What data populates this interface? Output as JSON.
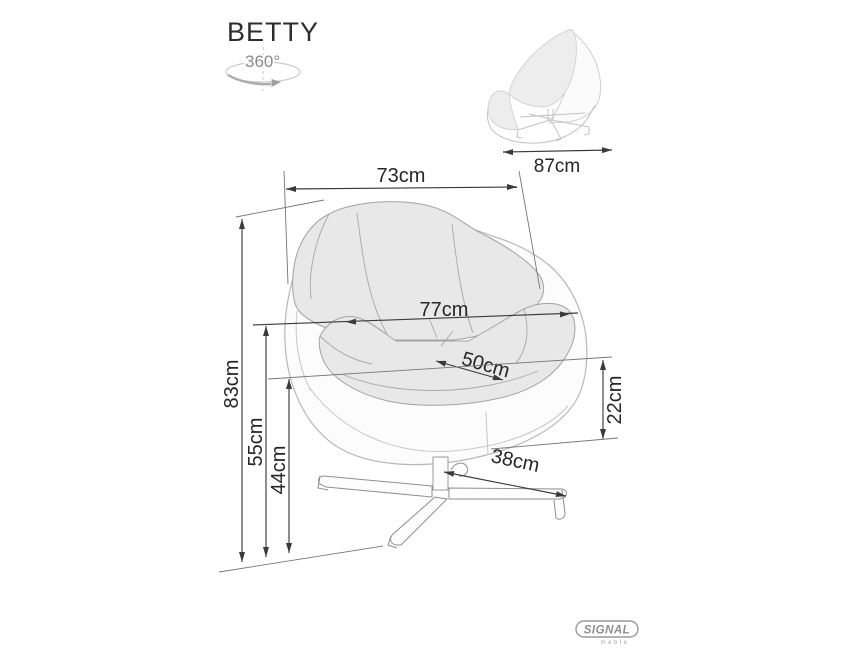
{
  "title": "BETTY",
  "rotation_icon": {
    "label": "360°"
  },
  "dims": {
    "depth": "87cm",
    "top_width": "73cm",
    "inner_width": "77cm",
    "seat_depth": "50cm",
    "total_height": "83cm",
    "inner_height": "55cm",
    "seat_height": "44cm",
    "shell_edge_height": "22cm",
    "base_leg_length": "38cm"
  },
  "brand": {
    "name": "SIGNAL",
    "subtitle": "meble"
  },
  "colors": {
    "dimension_line": "#3a3a3a",
    "label_text": "#262626",
    "drawing_line": "#b8b8b8",
    "cushion_fill": "#e8e8e8",
    "brand_gray": "#8f8f8f",
    "background": "#ffffff"
  }
}
